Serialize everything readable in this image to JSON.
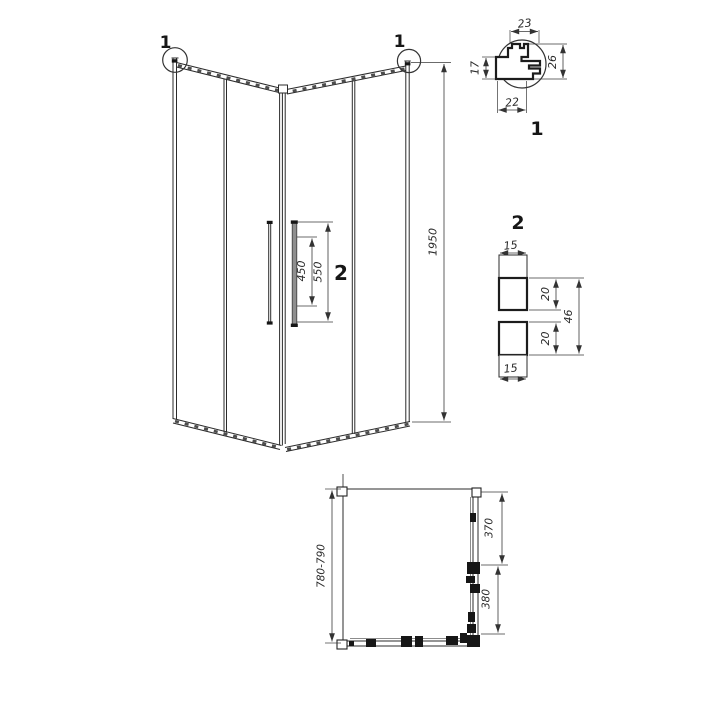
{
  "elevation": {
    "detail_marker_left": "1",
    "detail_marker_right": "1",
    "height_dim": "1950",
    "handle_inner_dim": "450",
    "handle_outer_dim": "550",
    "handle_marker": "2"
  },
  "detail_1": {
    "caption": "1",
    "top_width": "23",
    "left_height": "17",
    "right_height": "26",
    "bottom_width": "22"
  },
  "detail_2": {
    "caption": "2",
    "top_cap": "15",
    "upper_bar": "20",
    "overall": "46",
    "lower_bar": "20",
    "bottom_cap": "15"
  },
  "plan": {
    "depth_dim": "780-790",
    "fixed_panel_dim": "370",
    "door_dim": "380"
  },
  "colors": {
    "line": "#2b2b2b",
    "dimension": "#3a3a3a",
    "handle_fill": "#8f8f8f",
    "background": "#ffffff"
  }
}
